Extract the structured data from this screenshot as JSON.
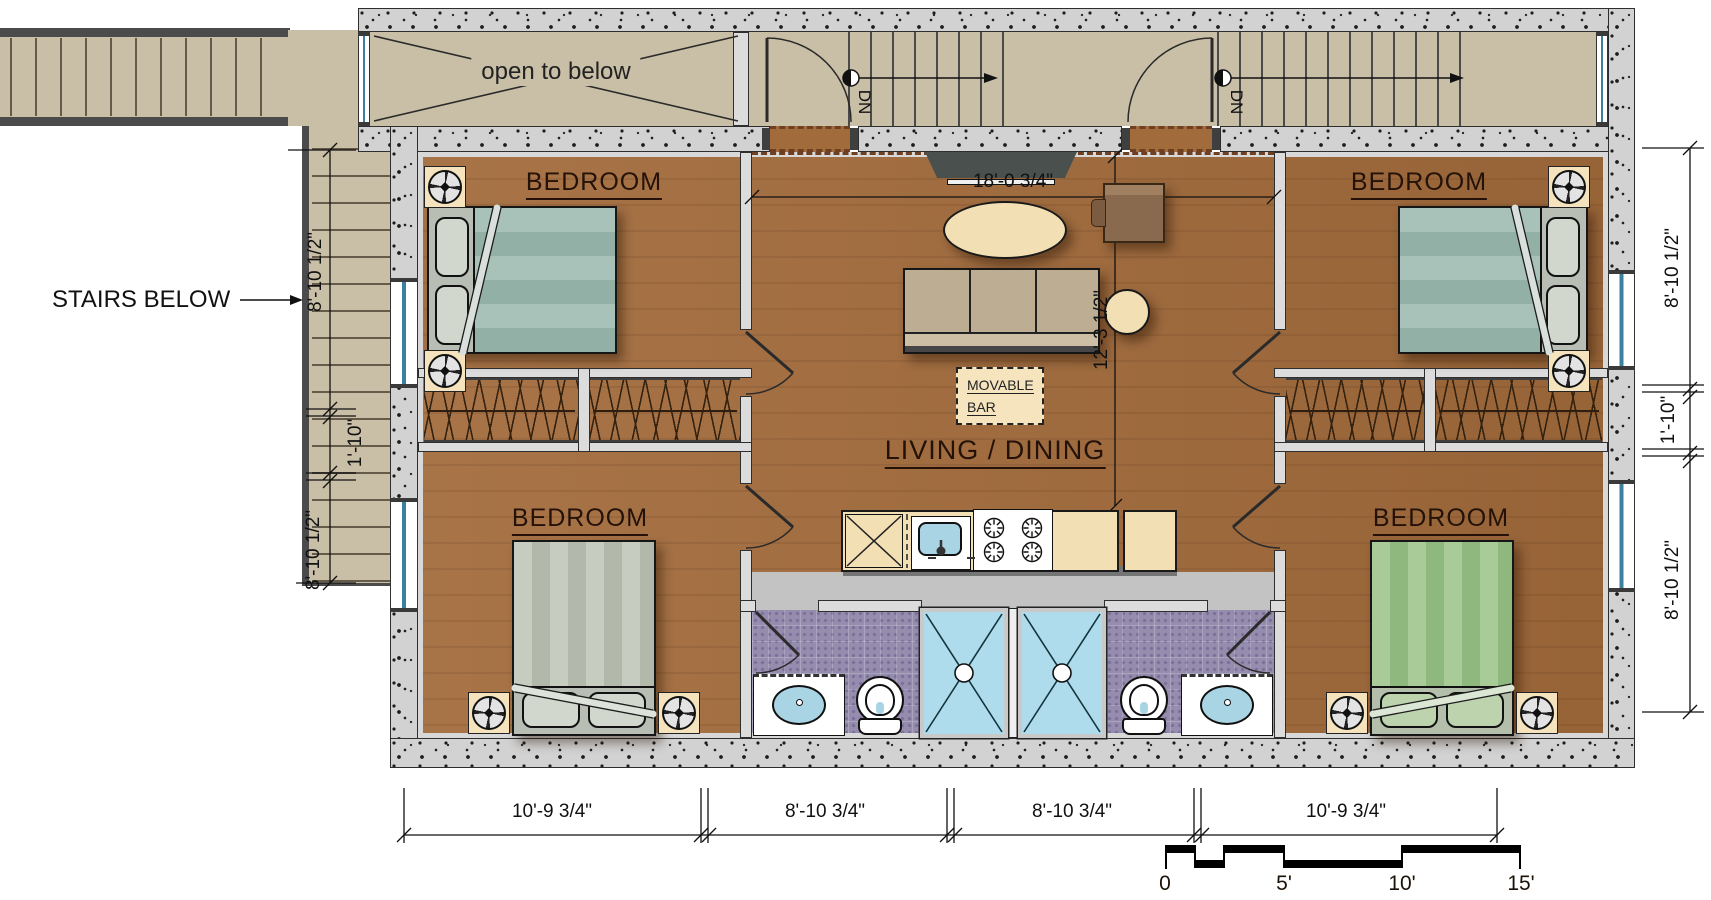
{
  "plan": {
    "labels": {
      "open_to_below": "open to below",
      "stairs_below": "STAIRS BELOW",
      "down_left": "DN",
      "down_right": "DN",
      "living_dining": "LIVING / DINING",
      "movable_bar_line1": "MOVABLE",
      "movable_bar_line2": "BAR",
      "bedrooms": [
        "BEDROOM",
        "BEDROOM",
        "BEDROOM",
        "BEDROOM"
      ]
    },
    "dimensions": {
      "living_width": "18'-0 3/4\"",
      "living_depth": "12'-3 1/2\"",
      "left": [
        "8'-10 1/2\"",
        "1'-10\"",
        "8'-10 1/2\""
      ],
      "right": [
        "8'-10 1/2\"",
        "1'-10\"",
        "8'-10 1/2\""
      ],
      "bottom": [
        "10'-9 3/4\"",
        "8'-10 3/4\"",
        "8'-10 3/4\"",
        "10'-9 3/4\""
      ]
    },
    "scale_bar": {
      "ticks": [
        "0",
        "5'",
        "10'",
        "15'"
      ]
    },
    "colors": {
      "wood_floor": "#a26b3c",
      "stair_floor": "#c9bfa7",
      "concrete_wall": "#d2d2d2",
      "bath_tile": "#958cae",
      "shower": "#aedcec",
      "counter": "#f2dfb3",
      "bed_teal": "#a5c0b8",
      "bed_gray": "#c2c8bd",
      "bed_green": "#a9cb97"
    }
  }
}
